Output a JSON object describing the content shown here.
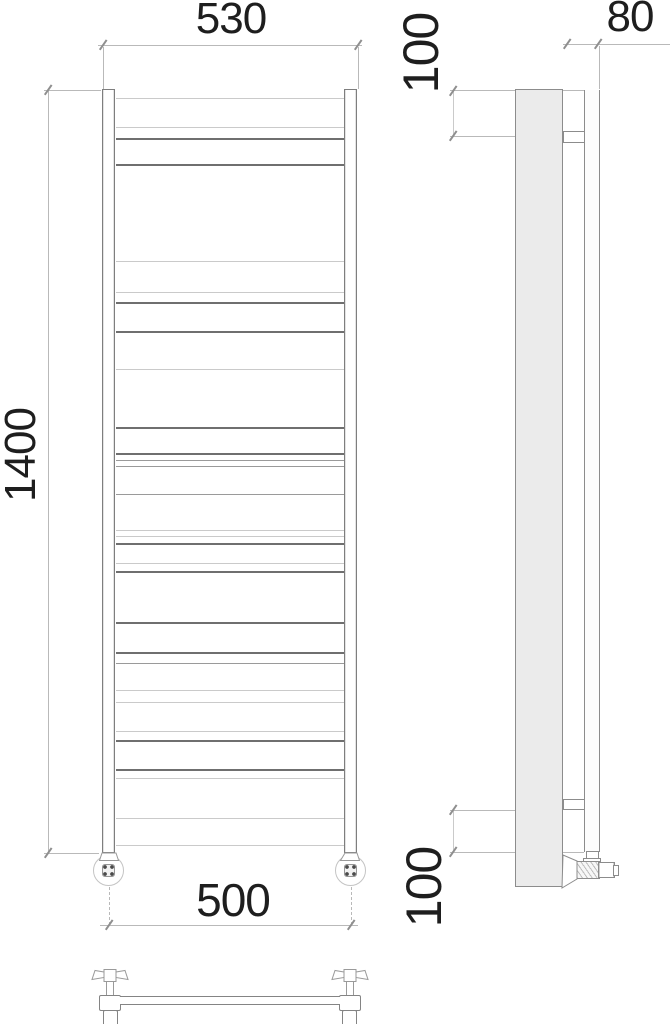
{
  "drawing": {
    "type": "technical-drawing",
    "subject": "ladder towel radiator orthographic views: front, side and bottom",
    "dim_labels": {
      "top_width": "530",
      "side_depth": "80",
      "side_top_offset": "100",
      "height": "1400",
      "bottom_width": "500",
      "side_bottom_offset": "100"
    },
    "colors": {
      "background": "#ffffff",
      "text": "#1e1e1e",
      "line_dark": "#6f6f6f",
      "line_medium": "#9a9a9a",
      "line_light": "#cacaca",
      "dimension_line": "#b9b9b9",
      "tick": "#8f8f8f",
      "panel_fill": "#ebebeb",
      "outline": "#8a8a8a"
    },
    "geometry": {
      "shade_map": {
        "dim": "#b9b9b9",
        "d": "#6f6f6f",
        "m": "#9a9a9a",
        "l": "#cacaca"
      },
      "lines": [
        {
          "x": 116,
          "y": 98,
          "w": 228,
          "s": "l"
        },
        {
          "x": 116,
          "y": 127,
          "w": 228,
          "s": "l"
        },
        {
          "x": 116,
          "y": 138,
          "w": 228,
          "s": "d"
        },
        {
          "x": 116,
          "y": 164,
          "w": 228,
          "s": "d"
        },
        {
          "x": 116,
          "y": 261,
          "w": 228,
          "s": "l"
        },
        {
          "x": 116,
          "y": 292,
          "w": 228,
          "s": "l"
        },
        {
          "x": 116,
          "y": 302,
          "w": 228,
          "s": "d"
        },
        {
          "x": 116,
          "y": 331,
          "w": 228,
          "s": "d"
        },
        {
          "x": 116,
          "y": 369,
          "w": 228,
          "s": "l"
        },
        {
          "x": 116,
          "y": 427,
          "w": 228,
          "s": "d"
        },
        {
          "x": 116,
          "y": 453,
          "w": 228,
          "s": "d"
        },
        {
          "x": 116,
          "y": 460,
          "w": 228,
          "s": "m"
        },
        {
          "x": 116,
          "y": 466,
          "w": 228,
          "s": "m"
        },
        {
          "x": 116,
          "y": 494,
          "w": 228,
          "s": "m"
        },
        {
          "x": 116,
          "y": 530,
          "w": 228,
          "s": "l"
        },
        {
          "x": 116,
          "y": 536,
          "w": 228,
          "s": "l"
        },
        {
          "x": 116,
          "y": 543,
          "w": 228,
          "s": "d"
        },
        {
          "x": 116,
          "y": 563,
          "w": 228,
          "s": "l"
        },
        {
          "x": 116,
          "y": 571,
          "w": 228,
          "s": "d"
        },
        {
          "x": 116,
          "y": 622,
          "w": 228,
          "s": "d"
        },
        {
          "x": 116,
          "y": 652,
          "w": 228,
          "s": "d"
        },
        {
          "x": 116,
          "y": 663,
          "w": 228,
          "s": "m"
        },
        {
          "x": 116,
          "y": 690,
          "w": 228,
          "s": "l"
        },
        {
          "x": 116,
          "y": 702,
          "w": 228,
          "s": "l"
        },
        {
          "x": 116,
          "y": 731,
          "w": 228,
          "s": "l"
        },
        {
          "x": 116,
          "y": 740,
          "w": 228,
          "s": "d"
        },
        {
          "x": 116,
          "y": 769,
          "w": 228,
          "s": "d"
        },
        {
          "x": 116,
          "y": 778,
          "w": 228,
          "s": "l"
        },
        {
          "x": 116,
          "y": 818,
          "w": 228,
          "s": "l"
        },
        {
          "x": 116,
          "y": 845,
          "w": 228,
          "s": "l"
        },
        {
          "x": 121,
          "y": 1000,
          "w": 218,
          "s": "l"
        },
        {
          "x": 98,
          "y": 45,
          "w": 264,
          "s": "dim"
        },
        {
          "x": 563,
          "y": 44,
          "w": 107,
          "s": "dim"
        },
        {
          "x": 100,
          "y": 925,
          "w": 258,
          "s": "dim"
        },
        {
          "x": 44,
          "y": 90,
          "w": 57,
          "s": "dim"
        },
        {
          "x": 44,
          "y": 853,
          "w": 55,
          "s": "dim"
        },
        {
          "x": 450,
          "y": 90,
          "w": 150,
          "s": "dim"
        },
        {
          "x": 450,
          "y": 136,
          "w": 113,
          "s": "dim"
        },
        {
          "x": 450,
          "y": 810,
          "w": 113,
          "s": "dim"
        },
        {
          "x": 450,
          "y": 852,
          "w": 134,
          "s": "dim"
        },
        {
          "x": 48,
          "y": 90,
          "h": 763,
          "s": "dim"
        },
        {
          "x": 103,
          "y": 47,
          "h": 42,
          "s": "dim"
        },
        {
          "x": 358,
          "y": 47,
          "h": 42,
          "s": "dim"
        },
        {
          "x": 599,
          "y": 46,
          "h": 43,
          "s": "dim"
        },
        {
          "x": 453,
          "y": 91,
          "h": 45,
          "s": "l"
        },
        {
          "x": 453,
          "y": 810,
          "h": 42,
          "s": "l"
        },
        {
          "x": 109,
          "y": 887,
          "h": 38,
          "s": "dim",
          "dash": true
        },
        {
          "x": 351,
          "y": 887,
          "h": 38,
          "s": "dim",
          "dash": true
        }
      ],
      "ticks": [
        {
          "x": 103,
          "y": 45
        },
        {
          "x": 358,
          "y": 45
        },
        {
          "x": 567,
          "y": 44
        },
        {
          "x": 598,
          "y": 44
        },
        {
          "x": 48,
          "y": 90
        },
        {
          "x": 48,
          "y": 853
        },
        {
          "x": 109,
          "y": 925
        },
        {
          "x": 351,
          "y": 925
        },
        {
          "x": 453,
          "y": 91
        },
        {
          "x": 453,
          "y": 136
        },
        {
          "x": 453,
          "y": 810
        },
        {
          "x": 453,
          "y": 852
        }
      ]
    }
  }
}
